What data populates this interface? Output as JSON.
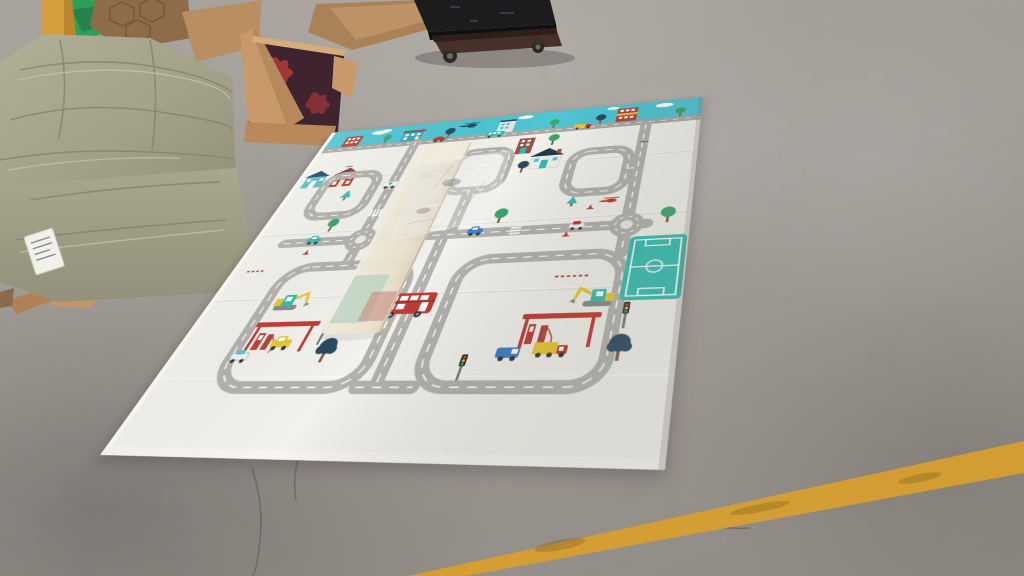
{
  "scene": {
    "description": "Foldable children's city-road play mat unrolled on a mottled concrete warehouse floor, surrounded by packing material",
    "setting": "warehouse interior, concrete floor",
    "objects": [
      {
        "name": "green-woven-sack-pile",
        "color": "#a6a58c",
        "position": "top-left"
      },
      {
        "name": "bright-green-cloth",
        "color": "#2f9e59",
        "position": "top-left behind sacks"
      },
      {
        "name": "yellow-post",
        "color": "#d49f3b",
        "position": "top-left"
      },
      {
        "name": "open-cardboard-box",
        "color": "#c89a6b",
        "interior_color": "#3f2430",
        "position": "top-center-left"
      },
      {
        "name": "flattened-cardboard-sheet",
        "color": "#ab8257",
        "position": "top-center"
      },
      {
        "name": "platform-scale-on-casters",
        "color": "#1c1c1f",
        "base_color": "#463029",
        "position": "top-center"
      },
      {
        "name": "cardboard-scraps",
        "color": "#b98e62",
        "position": "mid-left floor"
      },
      {
        "name": "play-mat",
        "color": "#f2f1eb",
        "position": "center, laid at an angle"
      },
      {
        "name": "foam-packing-strip",
        "color": "#efe8d6",
        "position": "lying across mat"
      },
      {
        "name": "clear-plastic-bag",
        "color": "rgba(235,240,242,0.3)",
        "position": "on foam strip"
      },
      {
        "name": "yellow-painted-floor-line",
        "color": "#d9a02c",
        "position": "bottom-right diagonal"
      }
    ]
  },
  "mat": {
    "style": "city road play mat with sky band",
    "sky_band_color": "#4fc5d3",
    "base_color": "#f2f1eb",
    "road_color": "#b3b2ae",
    "field_color": "#35bdb2",
    "bus_color": "#c23b36",
    "canopy_color": "#c23b36",
    "features": [
      "teal sky band with clouds, helicopter, buildings, trees and vehicles",
      "looping grey roads with white dashed centre lines",
      "two roundabouts",
      "teal soccer field",
      "two gas stations with red canopies",
      "red double-decker bus",
      "two excavators",
      "traffic lights",
      "green and navy trees",
      "small houses",
      "fold seam lines",
      "red cone and dash markings"
    ]
  },
  "floor": {
    "concrete_color": "#a29c96",
    "line_color": "#d9a02c",
    "crack_color": "rgba(60,55,50,0.35)"
  }
}
